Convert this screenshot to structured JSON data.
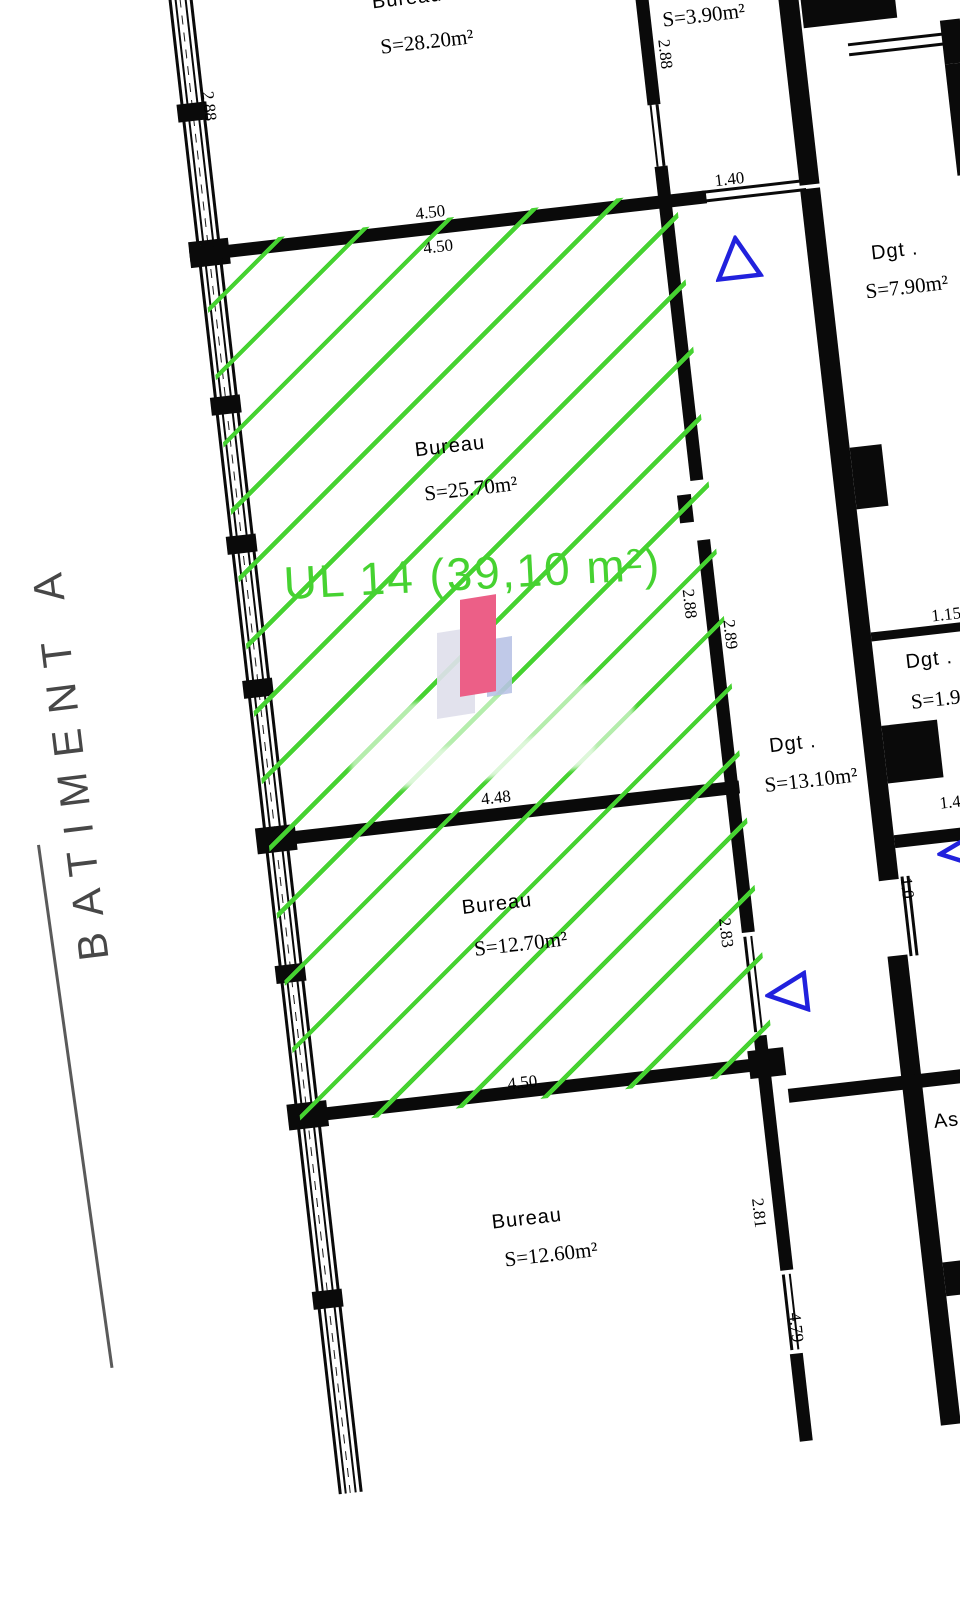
{
  "drawing": {
    "type": "architectural-floor-plan",
    "rotation_deg": -6.5
  },
  "colors": {
    "wall": "#0a0a0a",
    "hatch_green": "#46d231",
    "unit_text_green": "#46d231",
    "triangle_blue": "#2121dd",
    "building_label_gray": "#474747",
    "logo_pink": "#ec5f87",
    "logo_gray": "#dfe0ec",
    "logo_blue": "#b9c3e6"
  },
  "building": {
    "label": "BATIMENT A"
  },
  "unit": {
    "label": "UL 14 (39,10 m²)"
  },
  "rooms": [
    {
      "id": "bureau-top",
      "name": "Bureau",
      "area": "S=28.20m²"
    },
    {
      "id": "dgt-top",
      "name": "Dgt .",
      "area": "S=3.90m²"
    },
    {
      "id": "bureau-2570",
      "name": "Bureau",
      "area": "S=25.70m²"
    },
    {
      "id": "dgt-790",
      "name": "Dgt .",
      "area": "S=7.90m²"
    },
    {
      "id": "dgt-1310",
      "name": "Dgt .",
      "area": "S=13.10m²"
    },
    {
      "id": "dgt-19",
      "name": "Dgt .",
      "area": "S=1.9"
    },
    {
      "id": "bureau-1270",
      "name": "Bureau",
      "area": "S=12.70m²"
    },
    {
      "id": "bureau-1260",
      "name": "Bureau",
      "area": "S=12.60m²"
    },
    {
      "id": "ascenseur",
      "name": "As"
    }
  ],
  "dimensions": {
    "d288a": "2.88",
    "d288b": "2.88",
    "d450a": "4.50",
    "d450b": "4.50",
    "d140a": "1.40",
    "d288c": "2.88",
    "d289": "2.89",
    "d115": "1.15",
    "d448": "4.48",
    "d283": "2.83",
    "d10": "1.0",
    "d140b": "1.40",
    "d450c": "4.50",
    "d281": "2.81",
    "d479": "4.79"
  }
}
